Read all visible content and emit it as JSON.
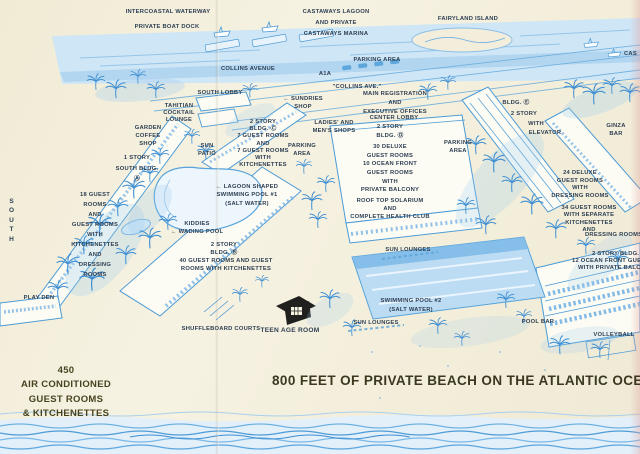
{
  "palette": {
    "paper": "#f3eedb",
    "ink": "#4b9ad6",
    "ink_light": "#cfe6f6",
    "ink_mid": "#8cc0e8",
    "label": "#2f4054",
    "dark": "#3b381f"
  },
  "headline": {
    "text": "800 FEET OF PRIVATE BEACH ON THE ATLANTIC OCEAN"
  },
  "caption": {
    "text": "450\nAIR CONDITIONED\nGUEST ROOMS\n& KITCHENETTES"
  },
  "labels": [
    {
      "name": "label-intercoastal-waterway",
      "x": 168,
      "y": 9,
      "text": "INTERCOASTAL WATERWAY"
    },
    {
      "name": "label-private-boat-dock",
      "x": 167,
      "y": 24,
      "text": "PRIVATE BOAT DOCK"
    },
    {
      "name": "label-castaways-lagoon-marina",
      "x": 336,
      "y": 7,
      "lh": 1.9,
      "text": "CASTAWAYS LAGOON\nAND PRIVATE\nCASTAWAYS MARINA"
    },
    {
      "name": "label-fairyland-island",
      "x": 468,
      "y": 16,
      "text": "FAIRYLAND ISLAND"
    },
    {
      "name": "label-castaways-truncated",
      "x": 624,
      "y": 51,
      "align": "left",
      "text": "CAS"
    },
    {
      "name": "label-parking-area-top",
      "x": 377,
      "y": 57,
      "text": "PARKING AREA"
    },
    {
      "name": "label-collins-avenue",
      "x": 248,
      "y": 66,
      "text": "COLLINS AVENUE"
    },
    {
      "name": "label-a1a",
      "x": 325,
      "y": 71,
      "text": "A1A"
    },
    {
      "name": "label-collins-ave-quoted",
      "x": 357,
      "y": 84,
      "text": "\"COLLINS AVE.\""
    },
    {
      "name": "label-south-lobby",
      "x": 220,
      "y": 90,
      "text": "SOUTH LOBBY"
    },
    {
      "name": "label-main-registration",
      "x": 395,
      "y": 90,
      "lh": 1.55,
      "text": "MAIN REGISTRATION\nAND\nEXECUTIVE OFFICES"
    },
    {
      "name": "label-sundries-shop",
      "x": 303,
      "y": 95,
      "lh": 1.4,
      "text": "← SUNDRIES\nSHOP"
    },
    {
      "name": "label-tahitian-cocktail-lounge",
      "x": 179,
      "y": 103,
      "lh": 1.22,
      "text": "TAHITIAN\nCOCKTAIL\nLOUNGE"
    },
    {
      "name": "label-bldg-e-title",
      "x": 516,
      "y": 100,
      "text": "BLDG. Ⓔ"
    },
    {
      "name": "label-bldg-e-2-story",
      "x": 524,
      "y": 111,
      "text": "2 STORY"
    },
    {
      "name": "label-bldg-e-with",
      "x": 536,
      "y": 121,
      "text": "WITH"
    },
    {
      "name": "label-bldg-e-elevator",
      "x": 545,
      "y": 130,
      "text": "ELEVATOR"
    },
    {
      "name": "label-ladies-mens-shops",
      "x": 334,
      "y": 119,
      "lh": 1.4,
      "text": "LADIES' AND\nMEN'S SHOPS"
    },
    {
      "name": "label-center-lobby",
      "x": 394,
      "y": 115,
      "text": "CENTER LOBBY"
    },
    {
      "name": "label-bldg-c-block",
      "x": 263,
      "y": 119,
      "lh": 1.24,
      "text": "2 STORY\nBLDG. Ⓒ\n7 GUEST ROOMS\nAND\n7 GUEST ROOMS\nWITH\nKITCHENETTES"
    },
    {
      "name": "label-garden-coffee-shop",
      "x": 148,
      "y": 125,
      "lh": 1.38,
      "text": "GARDEN\nCOFFEE\nSHOP"
    },
    {
      "name": "label-bldg-d-2-story",
      "x": 390,
      "y": 124,
      "text": "2 STORY"
    },
    {
      "name": "label-bldg-d-title",
      "x": 390,
      "y": 133,
      "text": "BLDG. Ⓓ"
    },
    {
      "name": "label-ginza-bar",
      "x": 616,
      "y": 123,
      "lh": 1.3,
      "text": "GINZA\nBAR"
    },
    {
      "name": "label-parking-area-right",
      "x": 458,
      "y": 140,
      "lh": 1.35,
      "text": "PARKING\nAREA"
    },
    {
      "name": "label-parking-area-left",
      "x": 302,
      "y": 143,
      "lh": 1.35,
      "text": "PARKING\nAREA"
    },
    {
      "name": "label-bldg-d-deluxe-block",
      "x": 390,
      "y": 143,
      "lh": 1.5,
      "text": "30 DELUXE\nGUEST ROOMS\n10 OCEAN FRONT\nGUEST ROOMS\nWITH\nPRIVATE BALCONY"
    },
    {
      "name": "label-south-bldg-a",
      "x": 137,
      "y": 153,
      "lh": 1.85,
      "text": "1 STORY\nSOUTH BLDG.\nⒶ"
    },
    {
      "name": "label-sun-patio",
      "x": 207,
      "y": 143,
      "lh": 1.38,
      "text": "SUN\nPATIO"
    },
    {
      "name": "label-24-deluxe-block",
      "x": 580,
      "y": 170,
      "lh": 1.3,
      "text": "24 DELUXE\nGUEST ROOMS\nWITH\nDRESSING ROOMS"
    },
    {
      "name": "label-lagoon-pool-1",
      "x": 247,
      "y": 183,
      "lh": 1.45,
      "text": "← LAGOON SHAPED\nSWIMMING POOL #1\n(SALT WATER)"
    },
    {
      "name": "label-18-guest-block",
      "x": 95,
      "y": 191,
      "lh": 1.72,
      "text": "18 GUEST\nROOMS\nAND\nGUEST ROOMS\nWITH\nKITCHENETTES\nAND\nDRESSING\nROOMS"
    },
    {
      "name": "label-roof-top-solarium",
      "x": 390,
      "y": 197,
      "lh": 1.42,
      "text": "ROOF TOP SOLARIUM\nAND\nCOMPLETE HEALTH CLUB"
    },
    {
      "name": "label-south-vertical",
      "x": 12,
      "y": 197,
      "fs": 6.5,
      "lh": 1.45,
      "ls": 1,
      "text": "S\nO\nU\nT\nH"
    },
    {
      "name": "label-34-guest-block",
      "x": 589,
      "y": 205,
      "lh": 1.26,
      "text": "34 GUEST ROOMS\nWITH SEPARATE\nKITCHENETTES\nAND"
    },
    {
      "name": "label-dressing-rooms-clipped",
      "x": 585,
      "y": 232,
      "align": "left",
      "text": "DRESSING ROOMS"
    },
    {
      "name": "label-kiddies-wading-pool",
      "x": 197,
      "y": 220,
      "lh": 1.4,
      "text": "KIDDIES\n← WADING POOL"
    },
    {
      "name": "label-bldg-b-block",
      "x": 224,
      "y": 241,
      "lh": 1.4,
      "text": "2 STORY\nBLDG. Ⓑ"
    },
    {
      "name": "label-40-guest-block",
      "x": 226,
      "y": 258,
      "lh": 1.38,
      "text": "40 GUEST ROOMS AND GUEST\nROOMS WITH KITCHENETTES"
    },
    {
      "name": "label-sun-lounges-upper",
      "x": 408,
      "y": 247,
      "text": "SUN LOUNGES"
    },
    {
      "name": "label-bldg-right-2story",
      "x": 592,
      "y": 251,
      "align": "left",
      "text": "2 STORY BLDG."
    },
    {
      "name": "label-bldg-right-ocean-front",
      "x": 572,
      "y": 258,
      "align": "left",
      "text": "12 OCEAN FRONT GUEST"
    },
    {
      "name": "label-bldg-right-private-balcony",
      "x": 578,
      "y": 265,
      "align": "left",
      "text": "WITH PRIVATE BALCONY"
    },
    {
      "name": "label-play-den",
      "x": 39,
      "y": 295,
      "text": "PLAY DEN"
    },
    {
      "name": "label-swimming-pool-2",
      "x": 411,
      "y": 297,
      "lh": 1.6,
      "text": "SWIMMING POOL #2\n(SALT WATER)"
    },
    {
      "name": "label-pool-bar",
      "x": 538,
      "y": 319,
      "text": "POOL BAR"
    },
    {
      "name": "label-sun-lounges-lower",
      "x": 376,
      "y": 320,
      "text": "SUN LOUNGES"
    },
    {
      "name": "label-shuffleboard-courts",
      "x": 221,
      "y": 326,
      "text": "SHUFFLEBOARD COURTS"
    },
    {
      "name": "label-teen-age-room",
      "x": 290,
      "y": 327,
      "fs": 6.6,
      "text": "TEEN AGE ROOM"
    },
    {
      "name": "label-volleyball",
      "x": 614,
      "y": 332,
      "text": "VOLLEYBALL"
    }
  ]
}
